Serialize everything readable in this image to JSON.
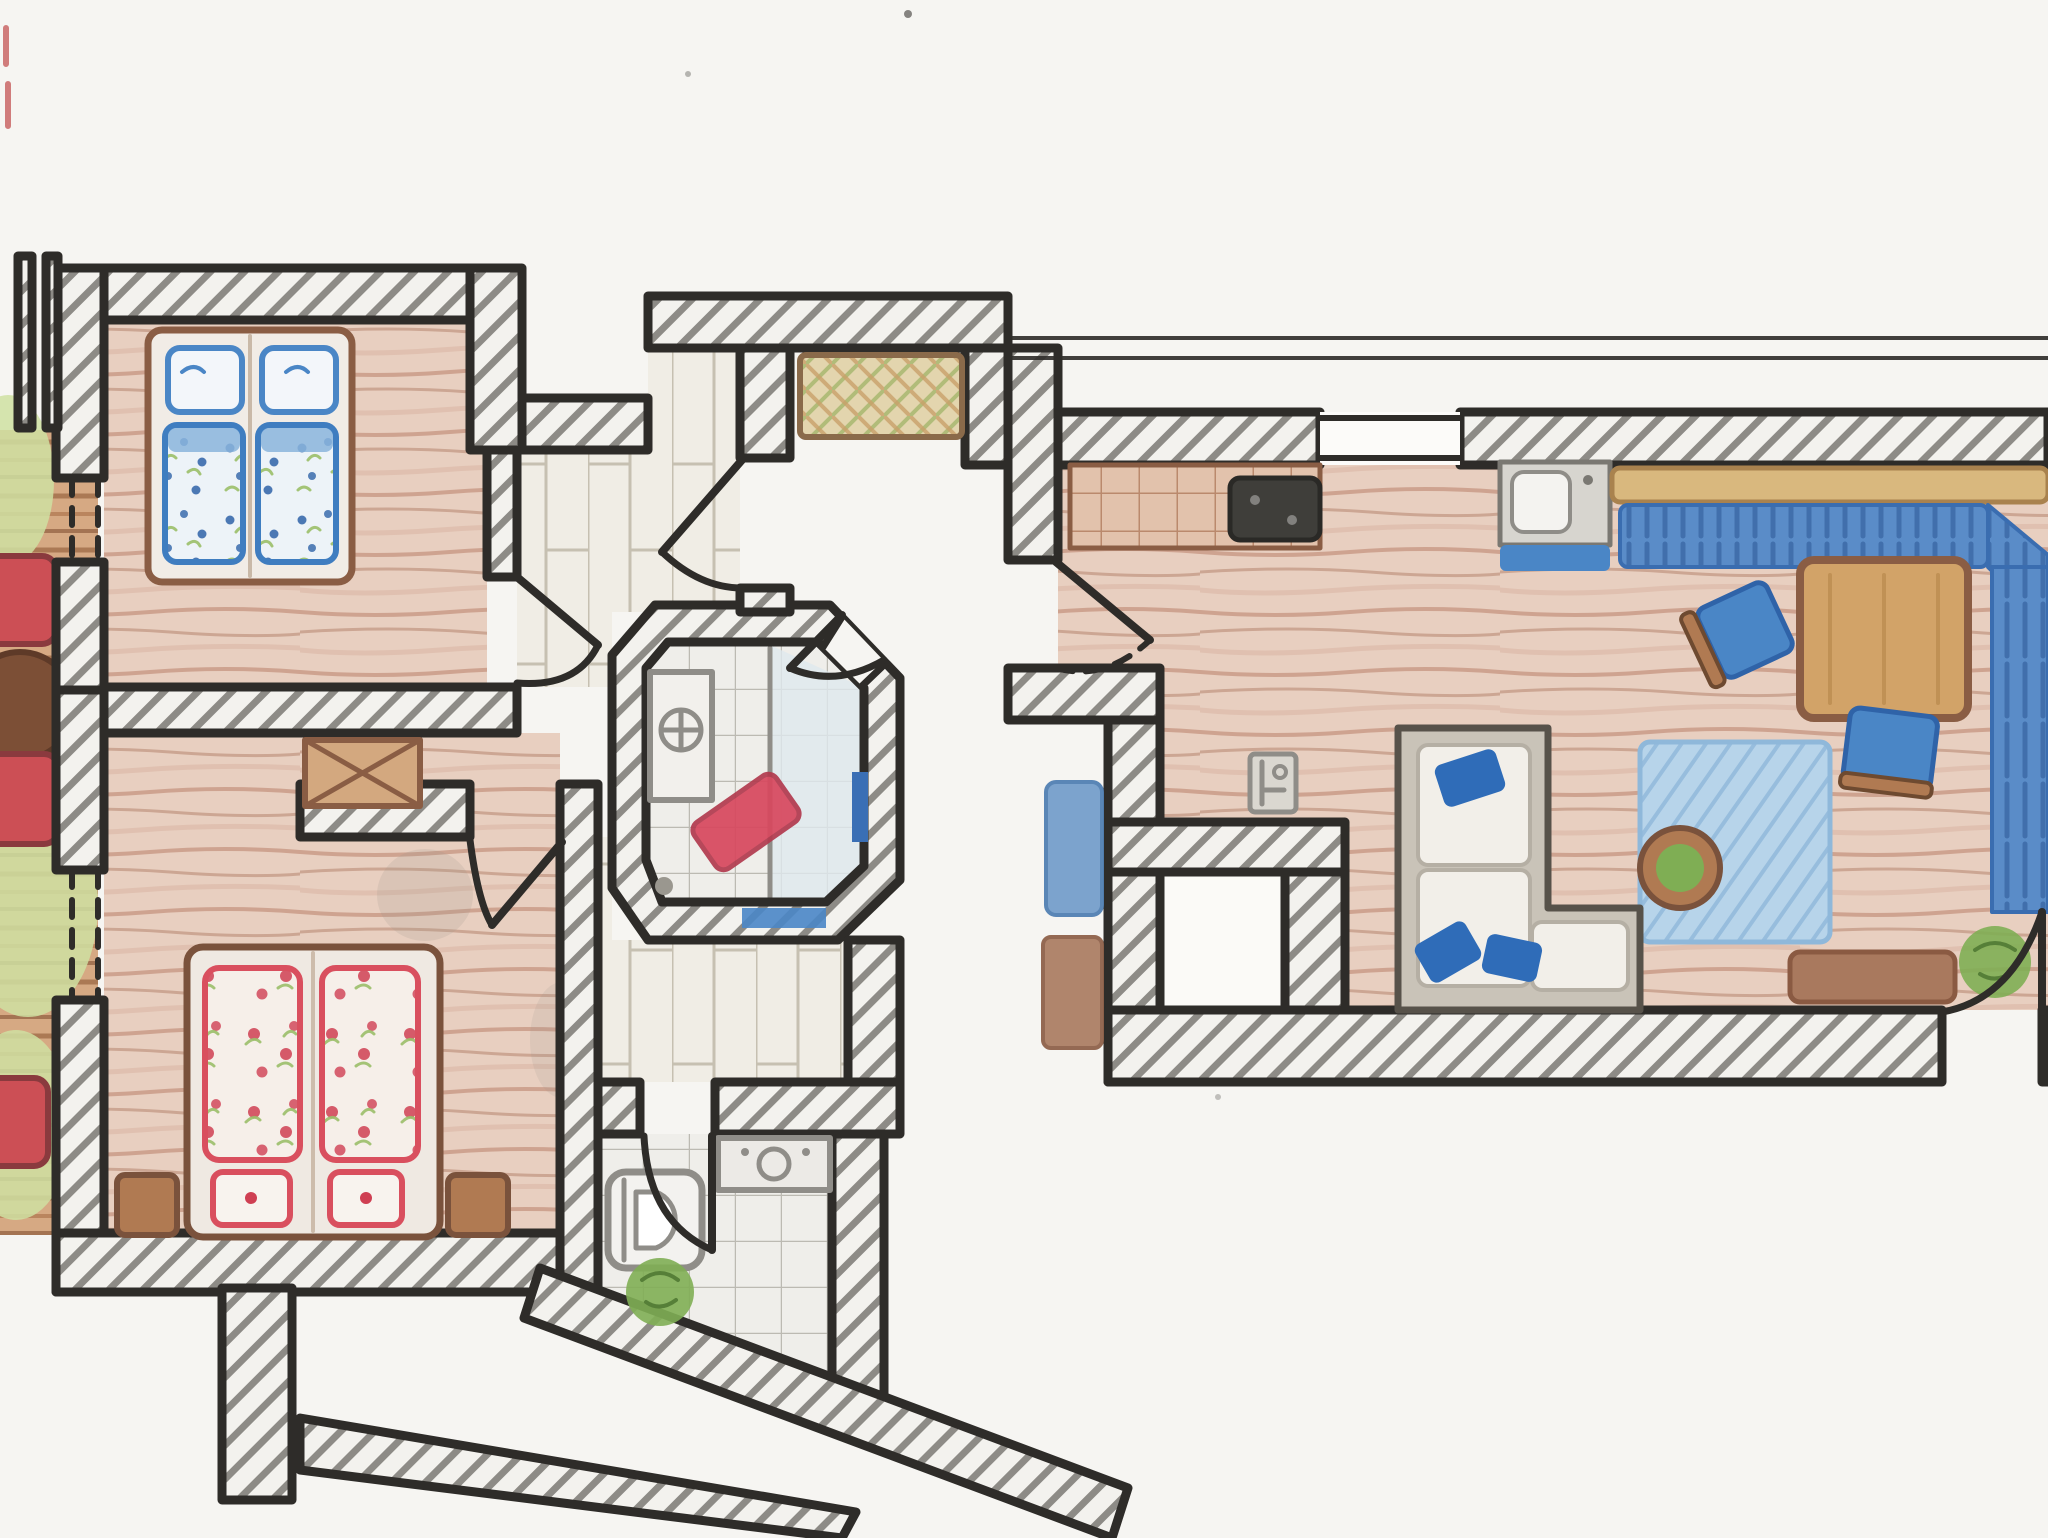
{
  "document": {
    "type": "hand-drawn apartment floor plan",
    "medium": "black ink outlines with colored-pencil shading on white paper",
    "layout": "two apartment units separated by a central stair vestibule; terrace strip cropped at the left edge",
    "canvas": {
      "width_px": 2048,
      "height_px": 1538
    },
    "visible_text": "none"
  },
  "palette": {
    "paper": "#f6f5f2",
    "ink": "#2e2c29",
    "hatch": "#73716b",
    "wood_floor": "#e8cfc0",
    "wood_stroke": "#bf8f79",
    "deck": "#d6a983",
    "plank": "#f0ede5",
    "tile": "#efeeea",
    "shower": "#dfe9ee",
    "blue_bedding": "#3f7dc0",
    "red_bedding": "#d94f5e",
    "green_leaf": "#9bbf6a",
    "grass": "#cfe0a2",
    "terracotta": "#e2c2ac",
    "bench_blue": "#5a8cc8",
    "chair_blue": "#4a86c6",
    "pillow_blue": "#2f6cb8",
    "rug_blue": "#b7d4ea",
    "rug_stroke": "#8fb8da",
    "chair_red": "#cc4f55",
    "garden_table": "#7c4f36",
    "table_wood": "#d2a368",
    "furniture_brown": "#b07a52",
    "chest_tan": "#d3a87f",
    "sofa_frame": "#c9c3b8",
    "cushion_white": "#f2efe9",
    "fixture_gray": "#8f8d88",
    "mat_red": "#d8485e",
    "towel_blue": "#3a6fb5",
    "plant_green": "#7fae54",
    "doormat_tan": "#e3d5ae",
    "cooktop_dark": "#3f3e3a",
    "mat_brown": "#a9795e",
    "hall_cushion": "#6f9bc9"
  },
  "apartment_left": {
    "rooms": [
      {
        "id": "bedroom-1",
        "floor": "pink-brown pencil wood",
        "furniture": [
          "double bed with two blue floral duvets and two blue pillows",
          "hinged door from hallway",
          "dashed terrace-door opening in west wall"
        ]
      },
      {
        "id": "bedroom-2",
        "floor": "pink-brown pencil wood",
        "furniture": [
          "double bed with two red floral duvets and two red pillows",
          "two brown nightstands",
          "storage chest with X-cross lid in wall niche",
          "hinged door from hallway",
          "dashed terrace-door opening in west wall"
        ]
      },
      {
        "id": "shower-bathroom",
        "shape": "angled octagon room in flat centre",
        "furniture": [
          "washbasin unit",
          "red bath mat laid diagonally",
          "walk-in shower area with glass screen line",
          "blue towel on east wall",
          "blue bath mat",
          "door on the angled wall"
        ]
      },
      {
        "id": "wc-bathroom",
        "furniture": [
          "toilet",
          "vanity counter with basin",
          "green plant",
          "hinged door from hallway",
          "angled exterior wall"
        ]
      },
      {
        "id": "hallway",
        "floor": "light wooden planks",
        "furniture": [
          "apartment entrance door from shared vestibule",
          "grey pencil smudges"
        ]
      }
    ],
    "terrace": {
      "position": "west edge, partially cropped",
      "items": [
        "wooden deck boards",
        "lawn patches",
        "three red garden chairs (cropped)",
        "round dark-brown garden table (cropped)",
        "cut wall stubs at top left"
      ]
    }
  },
  "shared_area": {
    "id": "stair-vestibule",
    "items": [
      "woven doormat with lattice pattern between the two apartment doors",
      "blue bench cushion",
      "brown mat",
      "two diagonal stair walls at the building entrance",
      "masonry pier"
    ]
  },
  "apartment_right": {
    "rooms": [
      {
        "id": "kitchen-living-room",
        "floor": "pink-brown pencil wood",
        "zones": [
          {
            "id": "kitchen",
            "items": [
              "terracotta tiled counter run",
              "dark cooktop",
              "sink unit with blue front",
              "window opening in north wall",
              "thin facade double line above the wall"
            ]
          },
          {
            "id": "dining",
            "items": [
              "blue corner bench with tan frame along north and east",
              "rectangular wooden table",
              "two blue chairs"
            ]
          },
          {
            "id": "lounge",
            "items": [
              "L-shaped sofa with white cushions and three blue pillows",
              "light blue rug",
              "potted plant on the rug",
              "brown lowboard",
              "green plant beside terrace door",
              "terrace door with quarter-circle swing",
              "entrance door with dashed swing arc",
              "built-in white closet",
              "radiator symbol near closet"
            ]
          }
        ]
      }
    ]
  }
}
